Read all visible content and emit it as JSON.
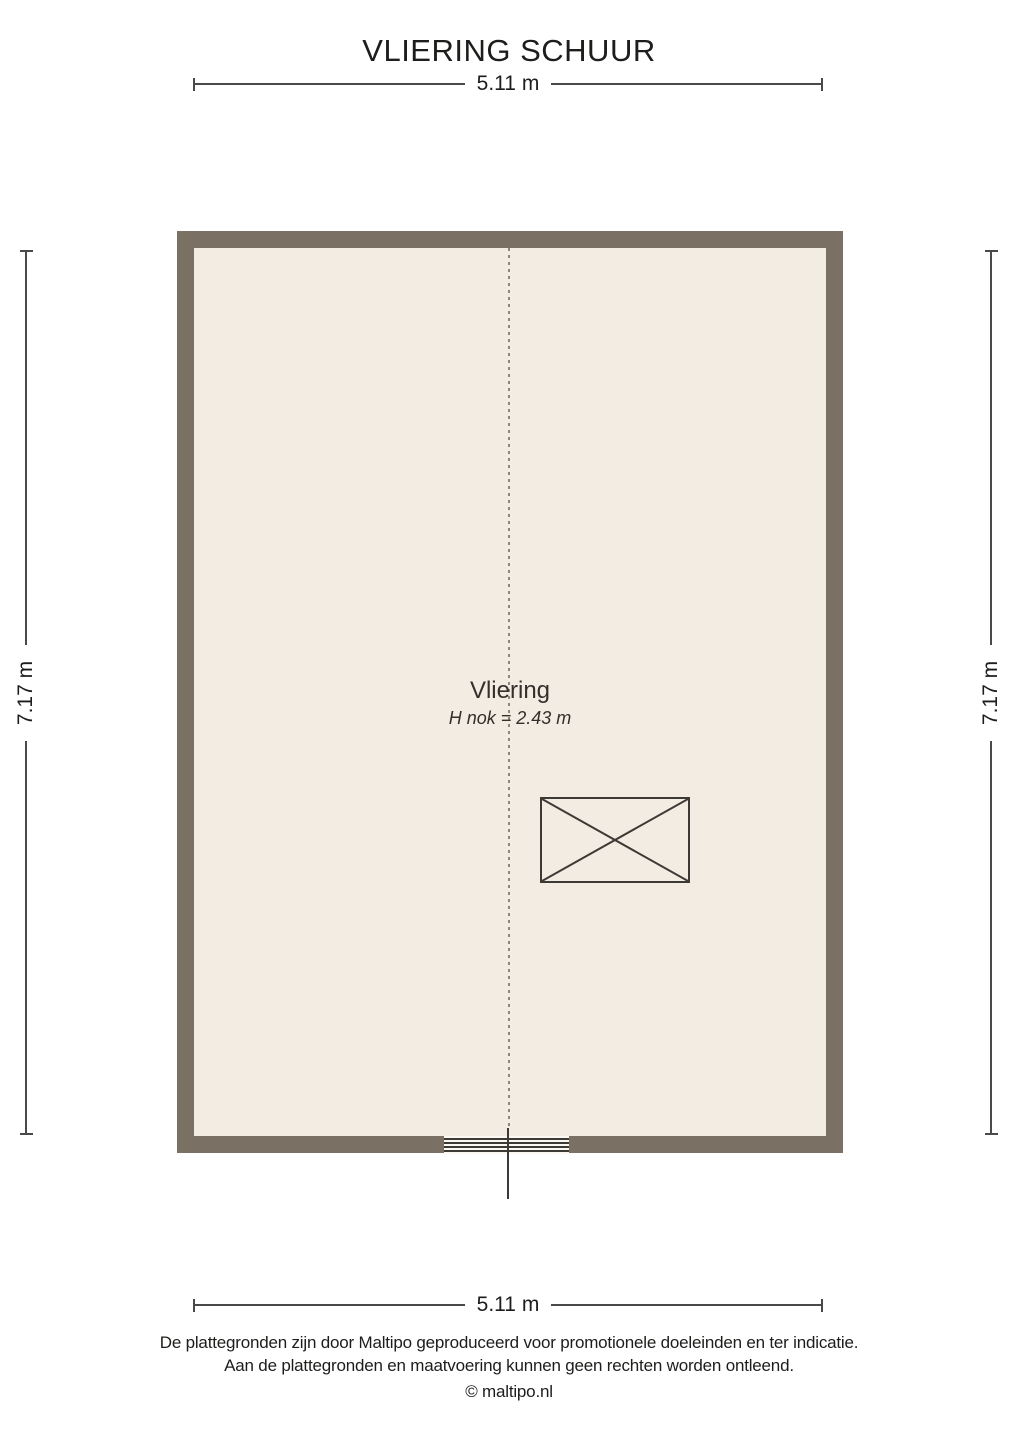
{
  "title": "VLIERING SCHUUR",
  "dimensions": {
    "top": "5.11 m",
    "bottom": "5.11 m",
    "left": "7.17 m",
    "right": "7.17 m"
  },
  "room": {
    "name": "Vliering",
    "ridge_height": "H nok = 2.43 m"
  },
  "footer": {
    "line1": "De plattegronden zijn door Maltipo geproduceerd voor promotionele doeleinden en ter indicatie.",
    "line2": "Aan de plattegronden en maatvoering kunnen geen rechten worden ontleend.",
    "copyright": "© maltipo.nl"
  },
  "colors": {
    "wall": "#7b7064",
    "floor": "#f2ece2",
    "symbol_line": "#3d3a35",
    "dimension_line": "#4a4a4a",
    "ridge_dash": "#8e887b",
    "text": "#1d1d1b"
  }
}
